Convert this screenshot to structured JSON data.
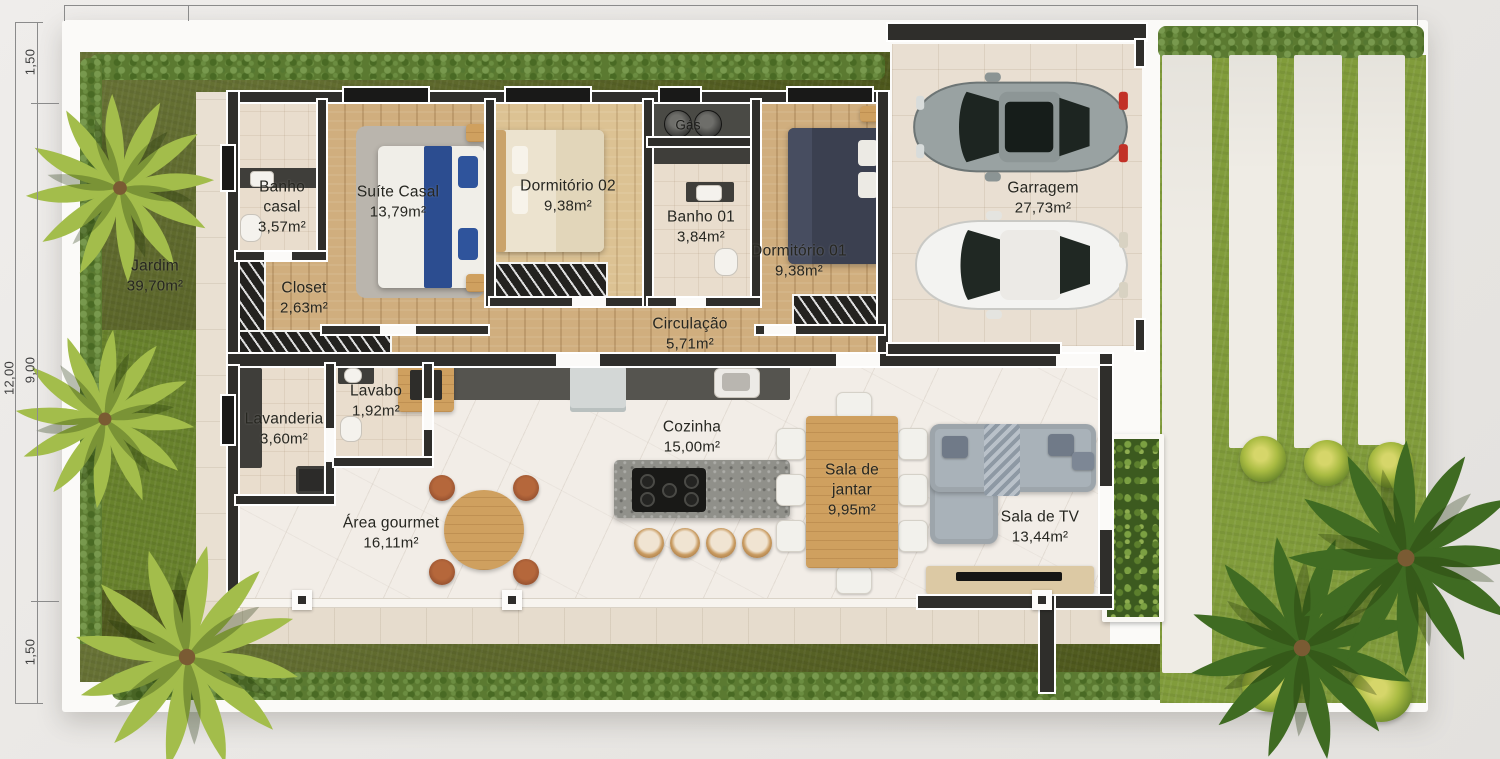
{
  "dimensions": {
    "total_height": "12,00",
    "top_segment": "1,50",
    "middle_segment": "9,00",
    "bottom_segment": "1,50"
  },
  "rooms": {
    "jardim": {
      "name": "Jardim",
      "area": "39,70m²"
    },
    "banho_casal": {
      "name": "Banho casal",
      "area": "3,57m²"
    },
    "suite_casal": {
      "name": "Suíte Casal",
      "area": "13,79m²"
    },
    "closet": {
      "name": "Closet",
      "area": "2,63m²"
    },
    "dormitorio_02": {
      "name": "Dormitório 02",
      "area": "9,38m²"
    },
    "gas": {
      "name": "Gás"
    },
    "banho_01": {
      "name": "Banho 01",
      "area": "3,84m²"
    },
    "dormitorio_01": {
      "name": "Dormitório 01",
      "area": "9,38m²"
    },
    "garagem": {
      "name": "Garragem",
      "area": "27,73m²"
    },
    "circulacao": {
      "name": "Circulação",
      "area": "5,71m²"
    },
    "lavanderia": {
      "name": "Lavanderia",
      "area": "3,60m²"
    },
    "lavabo": {
      "name": "Lavabo",
      "area": "1,92m²"
    },
    "cozinha": {
      "name": "Cozinha",
      "area": "15,00m²"
    },
    "area_gourmet": {
      "name": "Área gourmet",
      "area": "16,11m²"
    },
    "sala_de_jantar": {
      "name": "Sala de jantar",
      "area": "9,95m²"
    },
    "sala_de_tv": {
      "name": "Sala de TV",
      "area": "13,44m²"
    }
  },
  "colors": {
    "wall": "#2f2e2b",
    "wall_trim": "#ffffff",
    "garden_grass": "#57631f",
    "lawn": "#819c3b",
    "hedge": "#5b7a31",
    "wood_floor": "#d0ae7e",
    "marble_floor": "#f2ede7",
    "bath_tile": "#e9ddcd",
    "garage_tile": "#e9dfd2",
    "suite_bed_accent": "#2c4d90",
    "label_text": "#262620"
  }
}
